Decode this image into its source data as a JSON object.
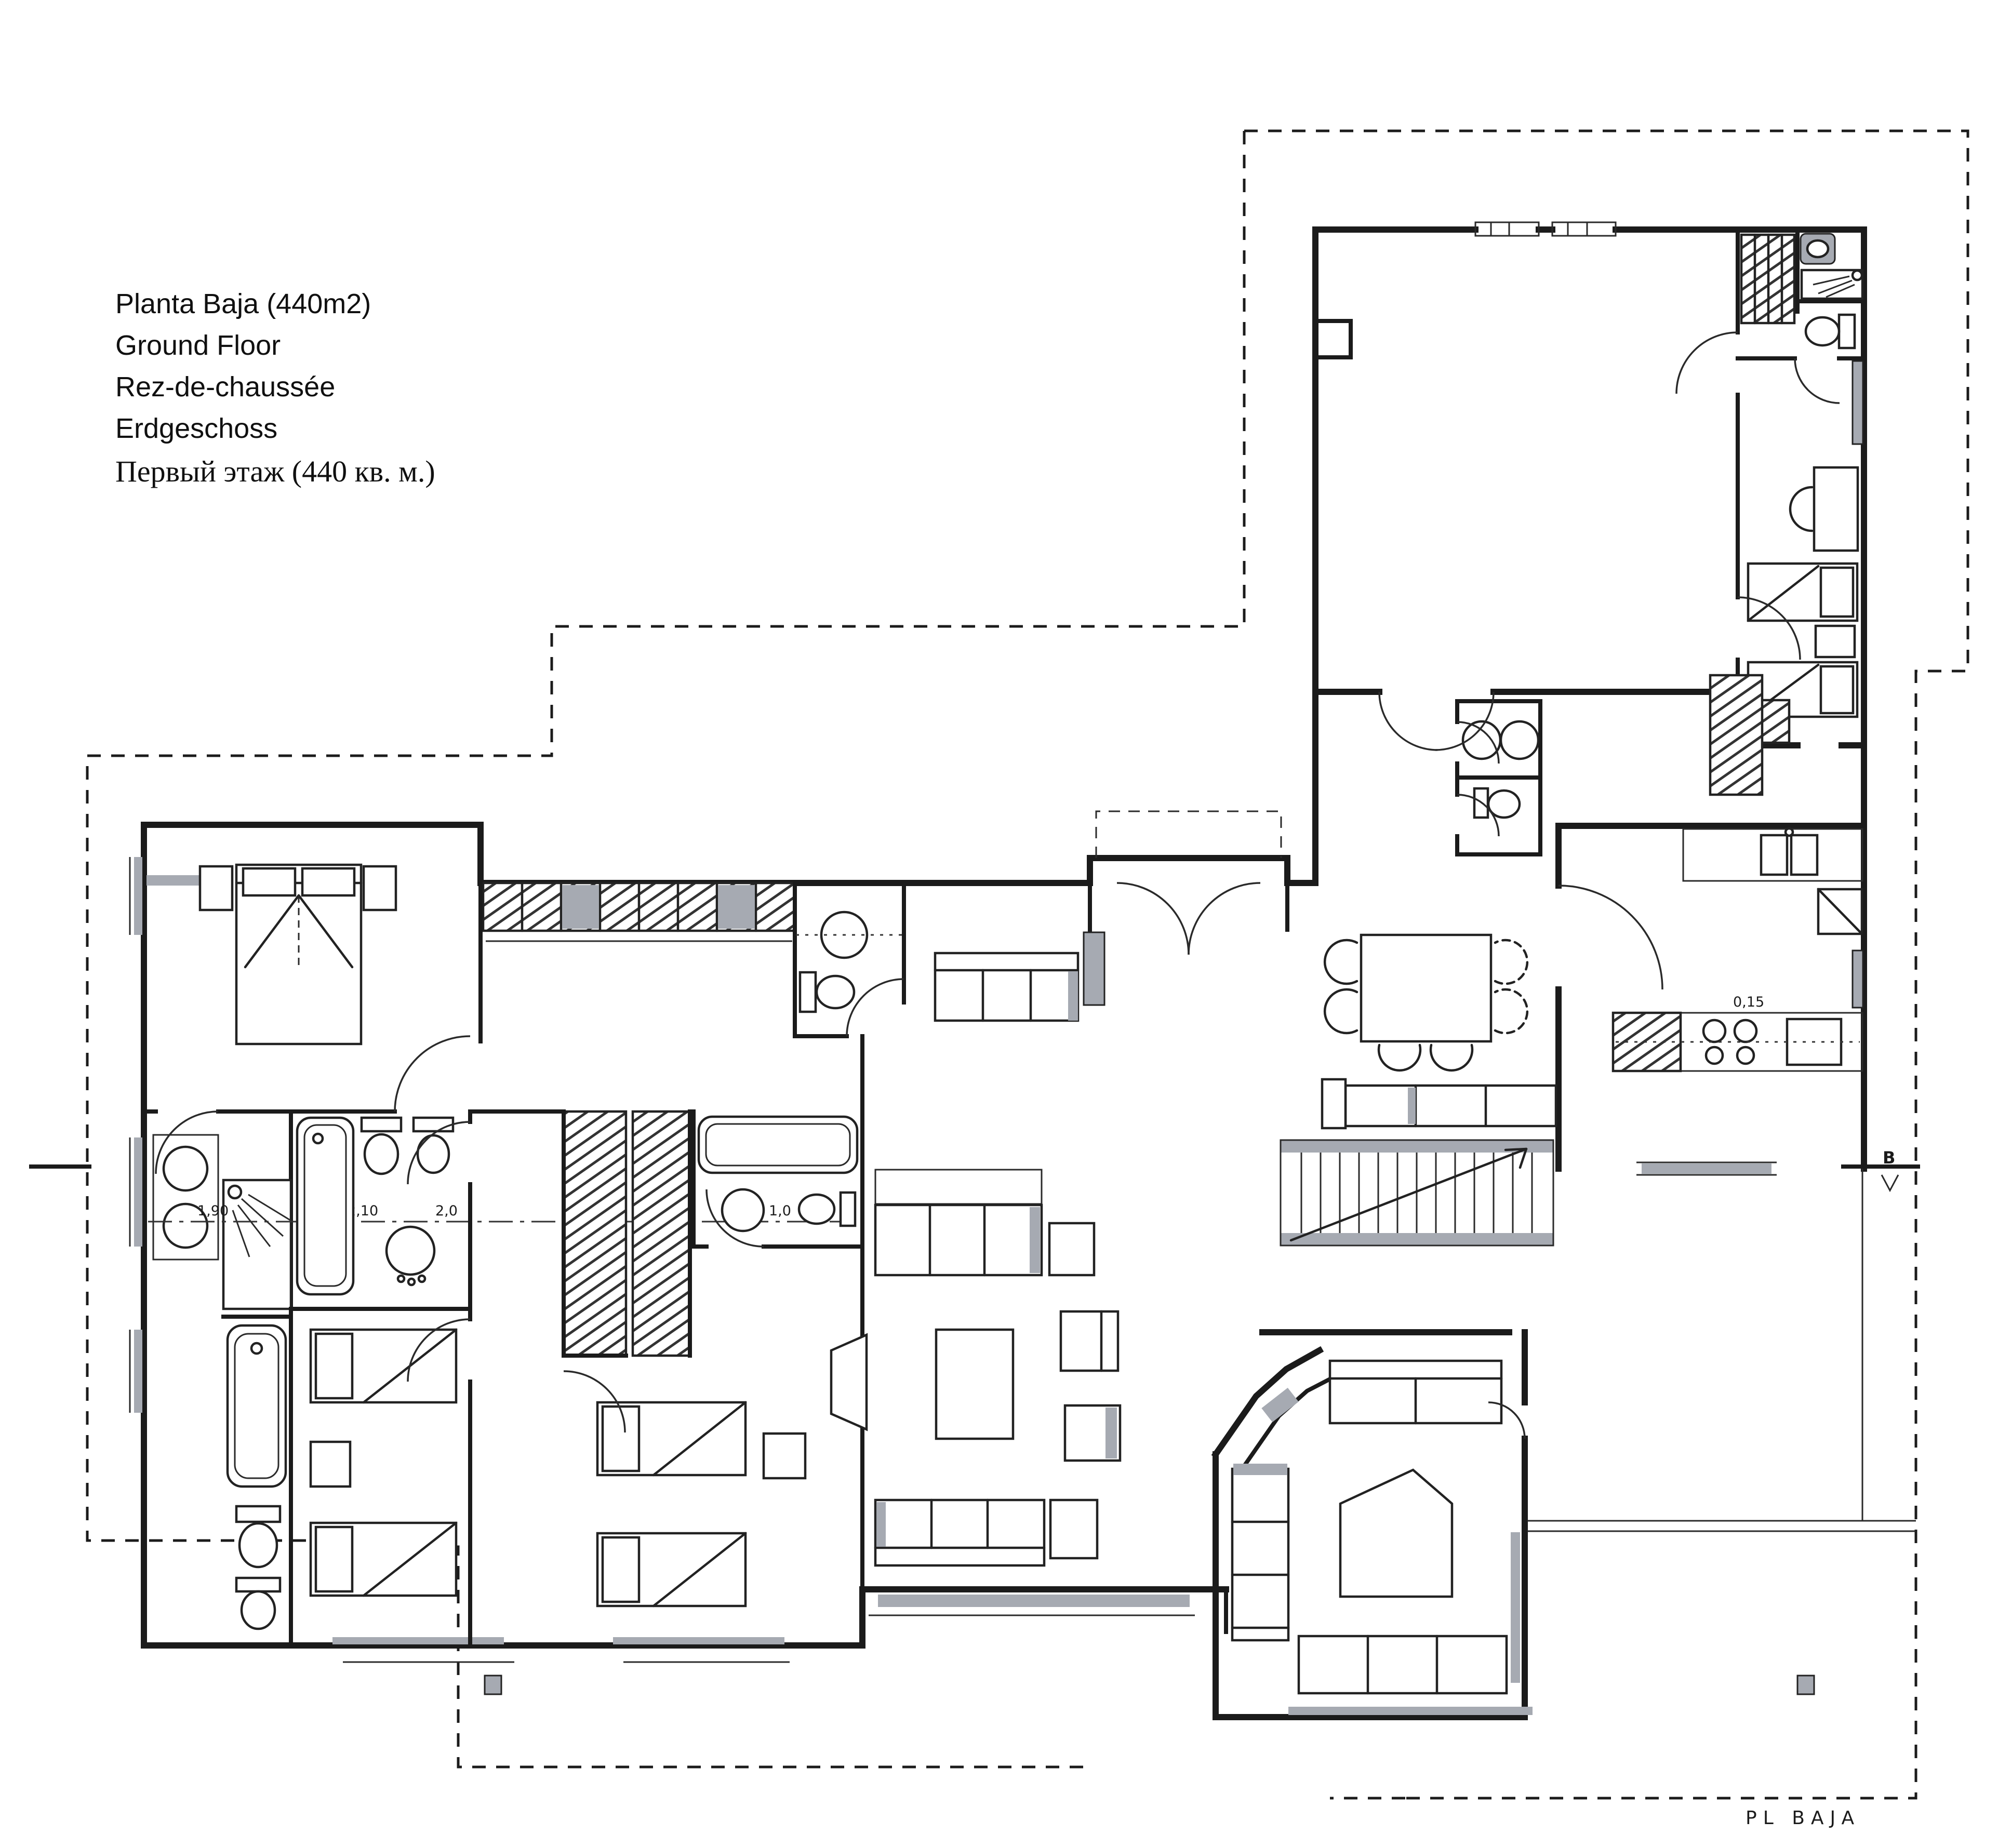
{
  "sheet": {
    "background": "#ffffff",
    "ink": "#1b1b1b",
    "accent_gray": "#a6aab2"
  },
  "title_block": {
    "lines": [
      "Planta Baja (440m2)",
      "Ground Floor",
      "Rez-de-chaussée",
      "Erdgeschoss",
      "Первый этаж (440 кв. м.)"
    ]
  },
  "annotations": {
    "plan_name": "PL  BAJA",
    "section_marker": "B",
    "dim_shower": "1,90",
    "dim_bathtub": "2,10",
    "dim_basin": "2,0",
    "dim_closet": "1,75",
    "dim_bath3": "1,0",
    "dim_kitchen": "0,15"
  }
}
